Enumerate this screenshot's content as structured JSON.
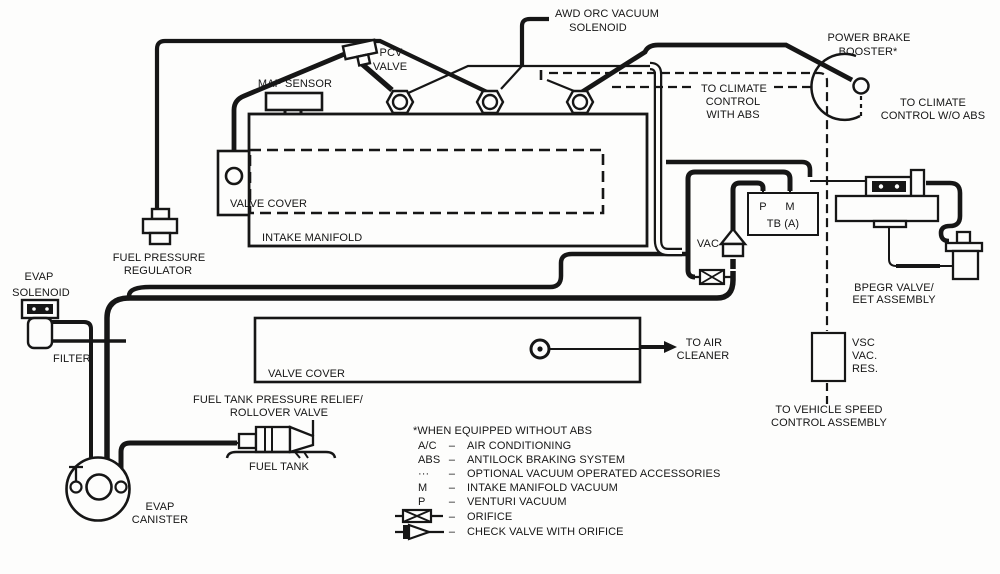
{
  "diagram": {
    "labels": {
      "awd1": "AWD ORC VACUUM",
      "awd2": "SOLENOID",
      "pcv1": "PCV",
      "pcv2": "VALVE",
      "map_sensor": "MAP SENSOR",
      "power_brake1": "POWER BRAKE",
      "power_brake2": "BOOSTER*",
      "climate_abs1": "TO CLIMATE",
      "climate_abs2": "CONTROL",
      "climate_abs3": "WITH ABS",
      "climate_wo1": "TO CLIMATE",
      "climate_wo2": "CONTROL W/O ABS",
      "valve_cover_top": "VALVE COVER",
      "intake_manifold": "INTAKE MANIFOLD",
      "fuel_pressure1": "FUEL PRESSURE",
      "fuel_pressure2": "REGULATOR",
      "evap_solenoid1": "EVAP",
      "evap_solenoid2": "SOLENOID",
      "filter": "FILTER",
      "vac": "VAC",
      "port_p": "P",
      "port_m": "M",
      "tb": "TB (A)",
      "bpegr1": "BPEGR VALVE/",
      "bpegr2": "EET ASSEMBLY",
      "valve_cover_bottom": "VALVE COVER",
      "air_cleaner1": "TO AIR",
      "air_cleaner2": "CLEANER",
      "vsc1": "VSC",
      "vsc2": "VAC.",
      "vsc3": "RES.",
      "speed_ctrl1": "TO VEHICLE SPEED",
      "speed_ctrl2": "CONTROL ASSEMBLY",
      "rollover1": "FUEL TANK PRESSURE RELIEF/",
      "rollover2": "ROLLOVER VALVE",
      "fuel_tank": "FUEL TANK",
      "evap_canister1": "EVAP",
      "evap_canister2": "CANISTER"
    },
    "legend": {
      "note": "*WHEN EQUIPPED WITHOUT ABS",
      "dash": "–",
      "entries": [
        {
          "key": "A/C",
          "desc": "AIR CONDITIONING"
        },
        {
          "key": "ABS",
          "desc": "ANTILOCK BRAKING SYSTEM"
        },
        {
          "key": "···",
          "desc": "OPTIONAL VACUUM OPERATED ACCESSORIES"
        },
        {
          "key": "M",
          "desc": "INTAKE MANIFOLD VACUUM"
        },
        {
          "key": "P",
          "desc": "VENTURI VACUUM"
        },
        {
          "key": "",
          "desc": "ORIFICE"
        },
        {
          "key": "",
          "desc": "CHECK VALVE WITH ORIFICE"
        }
      ]
    },
    "colors": {
      "ink": "#161616",
      "paper": "#fdfdfc"
    }
  }
}
